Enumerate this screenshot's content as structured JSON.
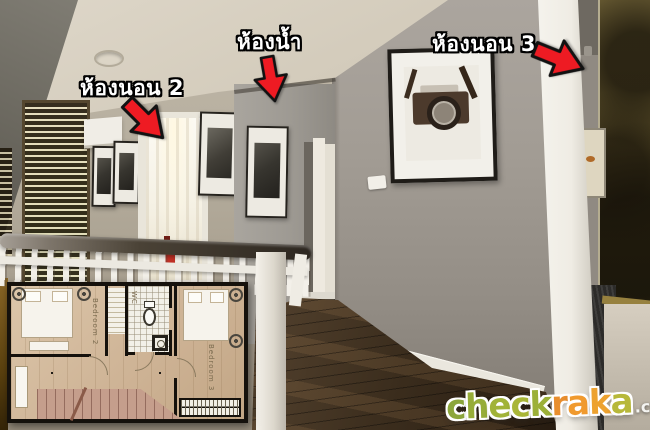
{
  "annotations": {
    "bedroom2": "ห้องนอน 2",
    "bathroom": "ห้องน้ำ",
    "bedroom3": "ห้องนอน 3"
  },
  "floorplan": {
    "bedroom2": "Bedroom 2",
    "wc": "WC",
    "bedroom3": "Bedroom 3"
  },
  "watermark": {
    "brand_letters": [
      {
        "char": "c",
        "color": "#8ca63b"
      },
      {
        "char": "h",
        "color": "#97ad39"
      },
      {
        "char": "e",
        "color": "#a1b338"
      },
      {
        "char": "c",
        "color": "#a9b637"
      },
      {
        "char": "k",
        "color": "#9cb038"
      },
      {
        "char": "r",
        "color": "#e88e2d"
      },
      {
        "char": "a",
        "color": "#f09a2e"
      },
      {
        "char": "k",
        "color": "#eda22f"
      },
      {
        "char": "a",
        "color": "#b7b83a"
      }
    ],
    "tld": ".com"
  },
  "colors": {
    "arrow_red": "#ee1b23",
    "arrow_outline": "#121212",
    "label_text": "#ffffff",
    "label_outline": "#000000"
  }
}
